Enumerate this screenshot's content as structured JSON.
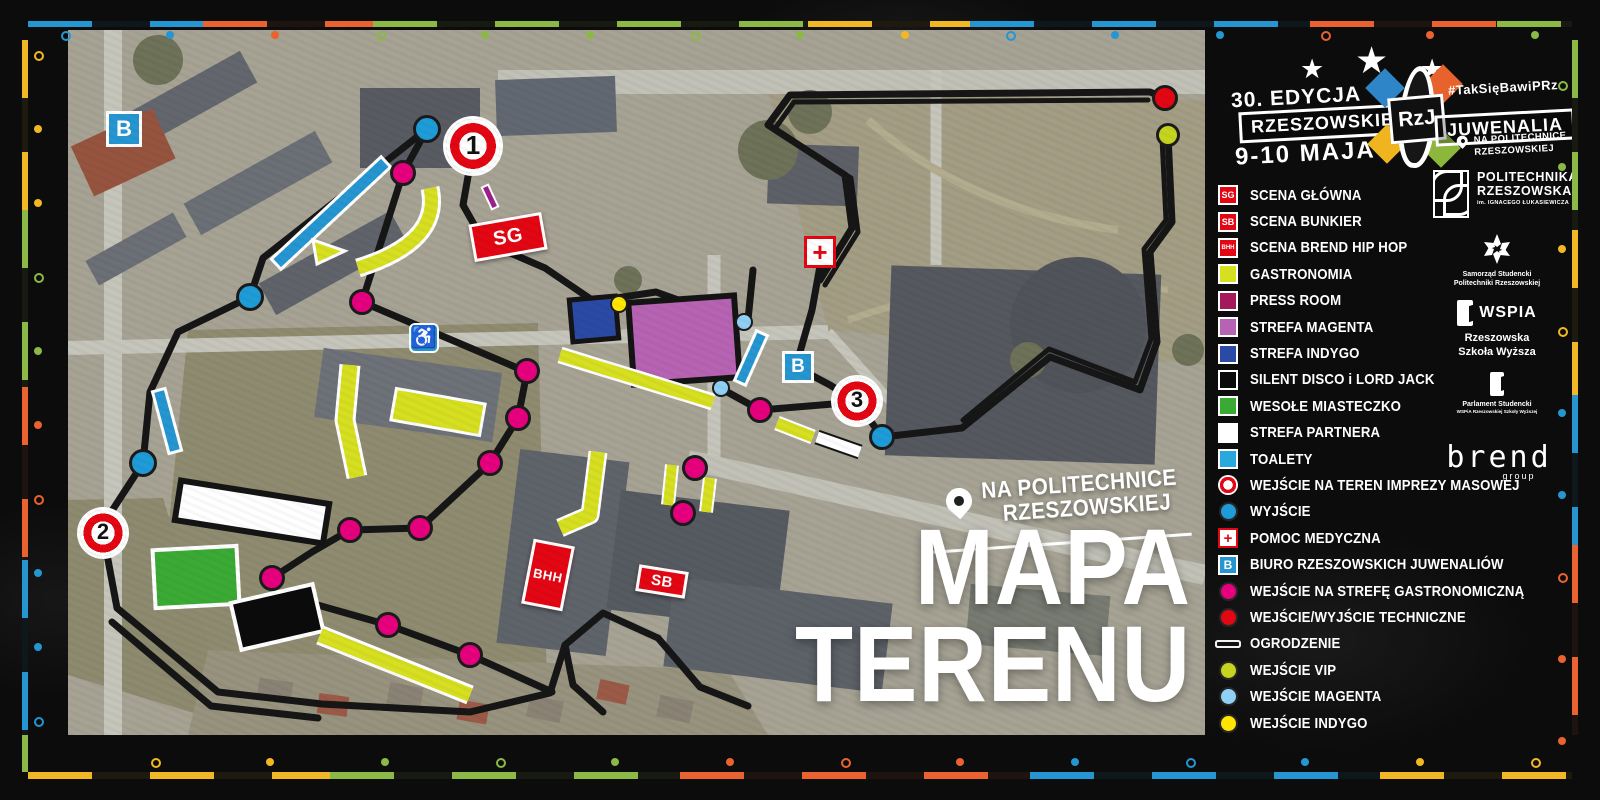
{
  "palette": {
    "red": "#e30613",
    "yellow_zone": "#d7df21",
    "press": "#a3195b",
    "magenta_zone": "#b763b3",
    "indigo": "#2b4aa5",
    "green_zone": "#3aaa35",
    "toilet_blue": "#29a8dd",
    "exit_cyan": "#1e9cd7",
    "gastro_magenta": "#e6007e",
    "vip_lime": "#c6d420",
    "entry_lightblue": "#8ed1f5",
    "entry_yellow": "#ffe500",
    "frame_blue": "#2596d1",
    "frame_orange": "#e96230",
    "frame_green": "#8cb945",
    "frame_yellow": "#f2b724"
  },
  "frame": {
    "top_segments": [
      {
        "c": "#2596d1",
        "a": 28,
        "b": 203
      },
      {
        "c": "#e96230",
        "a": 203,
        "b": 373
      },
      {
        "c": "#8cb945",
        "a": 373,
        "b": 808
      },
      {
        "c": "#f2b724",
        "a": 808,
        "b": 970
      },
      {
        "c": "#2596d1",
        "a": 970,
        "b": 1310
      },
      {
        "c": "#e96230",
        "a": 1310,
        "b": 1497
      },
      {
        "c": "#8cb945",
        "a": 1497,
        "b": 1572
      }
    ],
    "bottom_segments": [
      {
        "c": "#f2b724",
        "a": 28,
        "b": 330
      },
      {
        "c": "#8cb945",
        "a": 330,
        "b": 680
      },
      {
        "c": "#e96230",
        "a": 680,
        "b": 1030
      },
      {
        "c": "#2596d1",
        "a": 1030,
        "b": 1380
      },
      {
        "c": "#f2b724",
        "a": 1380,
        "b": 1572
      }
    ],
    "left_segments": [
      {
        "c": "#f2b724",
        "a": 40,
        "b": 210
      },
      {
        "c": "#8cb945",
        "a": 210,
        "b": 387
      },
      {
        "c": "#e96230",
        "a": 387,
        "b": 560
      },
      {
        "c": "#2596d1",
        "a": 560,
        "b": 735
      },
      {
        "c": "#8cb945",
        "a": 735,
        "b": 772
      }
    ],
    "right_segments": [
      {
        "c": "#8cb945",
        "a": 40,
        "b": 230
      },
      {
        "c": "#f2b724",
        "a": 230,
        "b": 395
      },
      {
        "c": "#2596d1",
        "a": 395,
        "b": 545
      },
      {
        "c": "#e96230",
        "a": 545,
        "b": 735
      }
    ]
  },
  "header": {
    "stars": "★",
    "edition": "30. EDYCJA",
    "brand_left": "RZESZOWSKIE",
    "logo_text": "RzJ",
    "brand_right": "JUWENALIA",
    "hashtag": "#TakSięBawiPRz",
    "dates": "9-10 MAJA",
    "location_line1": "NA POLITECHNICE",
    "location_line2": "RZESZOWSKIEJ"
  },
  "map": {
    "badge_line1": "NA POLITECHNICE",
    "badge_line2": "RZESZOWSKIEJ",
    "title_line1": "MAPA",
    "title_line2": "TERENU",
    "markers": [
      {
        "t": "target",
        "label": "1",
        "x": 405,
        "y": 116,
        "r": 27
      },
      {
        "t": "target",
        "label": "2",
        "x": 35,
        "y": 503,
        "r": 23
      },
      {
        "t": "target",
        "label": "3",
        "x": 789,
        "y": 371,
        "r": 23
      },
      {
        "t": "bbox",
        "label": "B",
        "x": 56,
        "y": 99,
        "s": 36
      },
      {
        "t": "bbox",
        "label": "B",
        "x": 730,
        "y": 337,
        "s": 32
      },
      {
        "t": "medical",
        "label": "+",
        "x": 752,
        "y": 222,
        "s": 32
      },
      {
        "t": "wheelchair",
        "label": "♿",
        "x": 356,
        "y": 308,
        "s": 30
      },
      {
        "t": "stage",
        "label": "SG",
        "x": 440,
        "y": 207,
        "w": 74,
        "h": 38,
        "rot": -10,
        "fs": 20
      },
      {
        "t": "stage",
        "label": "SB",
        "x": 594,
        "y": 551,
        "w": 50,
        "h": 27,
        "rot": 9,
        "fs": 15
      },
      {
        "t": "stage",
        "label": "BHH",
        "x": 480,
        "y": 545,
        "w": 42,
        "h": 66,
        "rot": 11,
        "fs": 13
      },
      {
        "t": "dot",
        "name": "exit",
        "color": "#1e9cd7",
        "r": 14,
        "x": 359,
        "y": 99
      },
      {
        "t": "dot",
        "name": "exit",
        "color": "#1e9cd7",
        "r": 14,
        "x": 182,
        "y": 267
      },
      {
        "t": "dot",
        "name": "exit",
        "color": "#1e9cd7",
        "r": 14,
        "x": 75,
        "y": 433
      },
      {
        "t": "dot",
        "name": "exit",
        "color": "#1e9cd7",
        "r": 13,
        "x": 814,
        "y": 407
      },
      {
        "t": "dot",
        "name": "technical",
        "color": "#e30613",
        "r": 13,
        "x": 1097,
        "y": 68
      },
      {
        "t": "dot",
        "name": "vip",
        "color": "#c6d420",
        "r": 12,
        "x": 1100,
        "y": 105
      },
      {
        "t": "dot",
        "name": "gastro",
        "color": "#e6007e",
        "r": 13,
        "x": 335,
        "y": 143
      },
      {
        "t": "dot",
        "name": "gastro",
        "color": "#e6007e",
        "r": 13,
        "x": 294,
        "y": 272
      },
      {
        "t": "dot",
        "name": "gastro",
        "color": "#e6007e",
        "r": 13,
        "x": 459,
        "y": 341
      },
      {
        "t": "dot",
        "name": "gastro",
        "color": "#e6007e",
        "r": 13,
        "x": 450,
        "y": 388
      },
      {
        "t": "dot",
        "name": "gastro",
        "color": "#e6007e",
        "r": 13,
        "x": 422,
        "y": 433
      },
      {
        "t": "dot",
        "name": "gastro",
        "color": "#e6007e",
        "r": 13,
        "x": 352,
        "y": 498
      },
      {
        "t": "dot",
        "name": "gastro",
        "color": "#e6007e",
        "r": 13,
        "x": 282,
        "y": 500
      },
      {
        "t": "dot",
        "name": "gastro",
        "color": "#e6007e",
        "r": 13,
        "x": 204,
        "y": 548
      },
      {
        "t": "dot",
        "name": "gastro",
        "color": "#e6007e",
        "r": 13,
        "x": 320,
        "y": 595
      },
      {
        "t": "dot",
        "name": "gastro",
        "color": "#e6007e",
        "r": 13,
        "x": 402,
        "y": 625
      },
      {
        "t": "dot",
        "name": "gastro",
        "color": "#e6007e",
        "r": 13,
        "x": 692,
        "y": 380
      },
      {
        "t": "dot",
        "name": "gastro",
        "color": "#e6007e",
        "r": 13,
        "x": 627,
        "y": 438
      },
      {
        "t": "dot",
        "name": "gastro",
        "color": "#e6007e",
        "r": 13,
        "x": 615,
        "y": 483
      },
      {
        "t": "dot",
        "name": "magenta-entry",
        "color": "#8ed1f5",
        "r": 9,
        "x": 676,
        "y": 292
      },
      {
        "t": "dot",
        "name": "magenta-entry",
        "color": "#8ed1f5",
        "r": 9,
        "x": 653,
        "y": 358
      },
      {
        "t": "dot",
        "name": "indygo-entry",
        "color": "#ffe500",
        "r": 9,
        "x": 551,
        "y": 274
      }
    ],
    "zones": [
      {
        "t": "rect",
        "x": 263,
        "y": 183,
        "w": 14,
        "h": 150,
        "rot": 47,
        "fill": "#2596d1",
        "stroke": "#ffffff",
        "sw": 3,
        "name": "toilets-strip"
      },
      {
        "t": "path",
        "d": "M 362,158 Q 374,212 290,238",
        "color": "#d7df21",
        "w": 13,
        "casing": "#ffffff",
        "cw": 19,
        "name": "gastro-arc"
      },
      {
        "t": "poly",
        "pts": "245,210 277,221 249,234",
        "fill": "#d7df21",
        "stroke": "#ffffff",
        "sw": 3,
        "name": "gastro-triangle"
      },
      {
        "t": "rect",
        "x": 422,
        "y": 167,
        "w": 7,
        "h": 24,
        "rot": -25,
        "fill": "#9b1f8e",
        "stroke": "#ffffff",
        "sw": 2,
        "name": "press-mark"
      },
      {
        "t": "rect",
        "x": 526,
        "y": 289,
        "w": 46,
        "h": 42,
        "rot": -5,
        "fill": "#2b4aa5",
        "stroke": "#141414",
        "sw": 5,
        "name": "indigo-zone"
      },
      {
        "t": "rect",
        "x": 616,
        "y": 310,
        "w": 106,
        "h": 82,
        "rot": -4,
        "fill": "#b763b3",
        "stroke": "#141414",
        "sw": 6,
        "name": "magenta-zone"
      },
      {
        "t": "rect",
        "x": 683,
        "y": 328,
        "w": 12,
        "h": 54,
        "rot": 24,
        "fill": "#2596d1",
        "stroke": "#ffffff",
        "sw": 3,
        "name": "toilets-strip"
      },
      {
        "t": "rect",
        "x": 99,
        "y": 391,
        "w": 13,
        "h": 64,
        "rot": -15,
        "fill": "#2596d1",
        "stroke": "#ffffff",
        "sw": 3,
        "name": "toilets-strip"
      },
      {
        "t": "rect",
        "x": 184,
        "y": 482,
        "w": 150,
        "h": 40,
        "rot": 9,
        "fill": "#ffffff",
        "stroke": "#141414",
        "sw": 6,
        "name": "partner-zone"
      },
      {
        "t": "rect",
        "x": 128,
        "y": 547,
        "w": 84,
        "h": 58,
        "rot": -3,
        "fill": "#3aaa35",
        "stroke": "#ffffff",
        "sw": 4,
        "name": "funfair-zone"
      },
      {
        "t": "rect",
        "x": 209,
        "y": 587,
        "w": 84,
        "h": 48,
        "rot": -13,
        "fill": "#0b0b0b",
        "stroke": "#ffffff",
        "sw": 4,
        "name": "silent-disco-zone"
      },
      {
        "t": "rect",
        "x": 370,
        "y": 382,
        "w": 90,
        "h": 32,
        "rot": 10,
        "fill": "#d7df21",
        "stroke": "#ffffff",
        "sw": 3,
        "name": "gastro-zone"
      },
      {
        "t": "line",
        "pts": "282,335 277,390 289,447",
        "color": "#d7df21",
        "w": 15,
        "casing": "#ffffff",
        "cw": 21,
        "name": "gastro-strip"
      },
      {
        "t": "line",
        "pts": "492,325 645,372",
        "color": "#d7df21",
        "w": 12,
        "casing": "#ffffff",
        "cw": 17,
        "name": "gastro-strip"
      },
      {
        "t": "line",
        "pts": "252,605 402,665",
        "color": "#d7df21",
        "w": 14,
        "casing": "#ffffff",
        "cw": 20,
        "name": "gastro-strip"
      },
      {
        "t": "line",
        "pts": "604,435 600,475",
        "color": "#d7df21",
        "w": 10,
        "casing": "#ffffff",
        "cw": 14,
        "name": "gastro-strip"
      },
      {
        "t": "line",
        "pts": "642,448 638,482",
        "color": "#d7df21",
        "w": 10,
        "casing": "#ffffff",
        "cw": 14,
        "name": "gastro-strip"
      },
      {
        "t": "line",
        "pts": "709,393 745,407",
        "color": "#d7df21",
        "w": 11,
        "casing": "#ffffff",
        "cw": 15,
        "name": "gastro-strip"
      },
      {
        "t": "line",
        "pts": "749,407 792,422",
        "color": "#ffffff",
        "w": 11,
        "casing": "#141414",
        "cw": 15,
        "name": "partner-strip"
      },
      {
        "t": "line",
        "pts": "530,422 522,485 492,498",
        "color": "#d7df21",
        "w": 14,
        "casing": "#ffffff",
        "cw": 19,
        "name": "gastro-strip"
      }
    ]
  },
  "legend": {
    "items": [
      {
        "kind": "stage",
        "tag": "SG",
        "label": "SCENA GŁÓWNA"
      },
      {
        "kind": "stage",
        "tag": "SB",
        "label": "SCENA BUNKIER"
      },
      {
        "kind": "stage",
        "tag": "BHH",
        "label": "SCENA BREND HIP HOP"
      },
      {
        "kind": "square",
        "color": "#d7df21",
        "label": "GASTRONOMIA"
      },
      {
        "kind": "square",
        "color": "#a3195b",
        "label": "PRESS ROOM"
      },
      {
        "kind": "square",
        "color": "#b763b3",
        "label": "STREFA MAGENTA"
      },
      {
        "kind": "square",
        "color": "#2b4aa5",
        "label": "STREFA INDYGO"
      },
      {
        "kind": "square",
        "color": "#0b0b0b",
        "label": "SILENT DISCO i LORD JACK"
      },
      {
        "kind": "square",
        "color": "#3aaa35",
        "label": "WESOŁE MIASTECZKO"
      },
      {
        "kind": "square",
        "color": "#ffffff",
        "label": "STREFA PARTNERA"
      },
      {
        "kind": "square",
        "color": "#29a8dd",
        "label": "TOALETY"
      },
      {
        "kind": "target",
        "label": "WEJŚCIE NA TEREN IMPREZY MASOWEJ"
      },
      {
        "kind": "circle",
        "color": "#1e9cd7",
        "label": "WYJŚCIE"
      },
      {
        "kind": "cross",
        "label": "POMOC MEDYCZNA"
      },
      {
        "kind": "bbox",
        "label": "BIURO RZESZOWSKICH JUWENALIÓW"
      },
      {
        "kind": "circle",
        "color": "#e6007e",
        "label": "WEJŚCIE NA STREFĘ GASTRONOMICZNĄ"
      },
      {
        "kind": "circle",
        "color": "#e30613",
        "label": "WEJŚCIE/WYJŚCIE TECHNICZNE"
      },
      {
        "kind": "line",
        "label": "OGRODZENIE"
      },
      {
        "kind": "circle",
        "color": "#c6d420",
        "label": "WEJŚCIE VIP"
      },
      {
        "kind": "circle",
        "color": "#8ed1f5",
        "label": "WEJŚCIE MAGENTA"
      },
      {
        "kind": "circle",
        "color": "#ffe500",
        "label": "WEJŚCIE INDYGO"
      }
    ]
  },
  "partners": {
    "prz": {
      "line1": "POLITECHNIKA",
      "line2": "RZESZOWSKA",
      "sub": "im. IGNACEGO ŁUKASIEWICZA"
    },
    "samorzad": {
      "line1": "Samorząd Studencki",
      "line2": "Politechniki Rzeszowskiej"
    },
    "wspia": {
      "title": "WSPIA",
      "line1": "Rzeszowska",
      "line2": "Szkoła Wyższa"
    },
    "parlament": {
      "line1": "Parlament Studencki",
      "line2": "WSPiA Rzeszowskiej Szkoły Wyższej"
    },
    "brend": {
      "title": "brend",
      "sub": "group"
    }
  }
}
